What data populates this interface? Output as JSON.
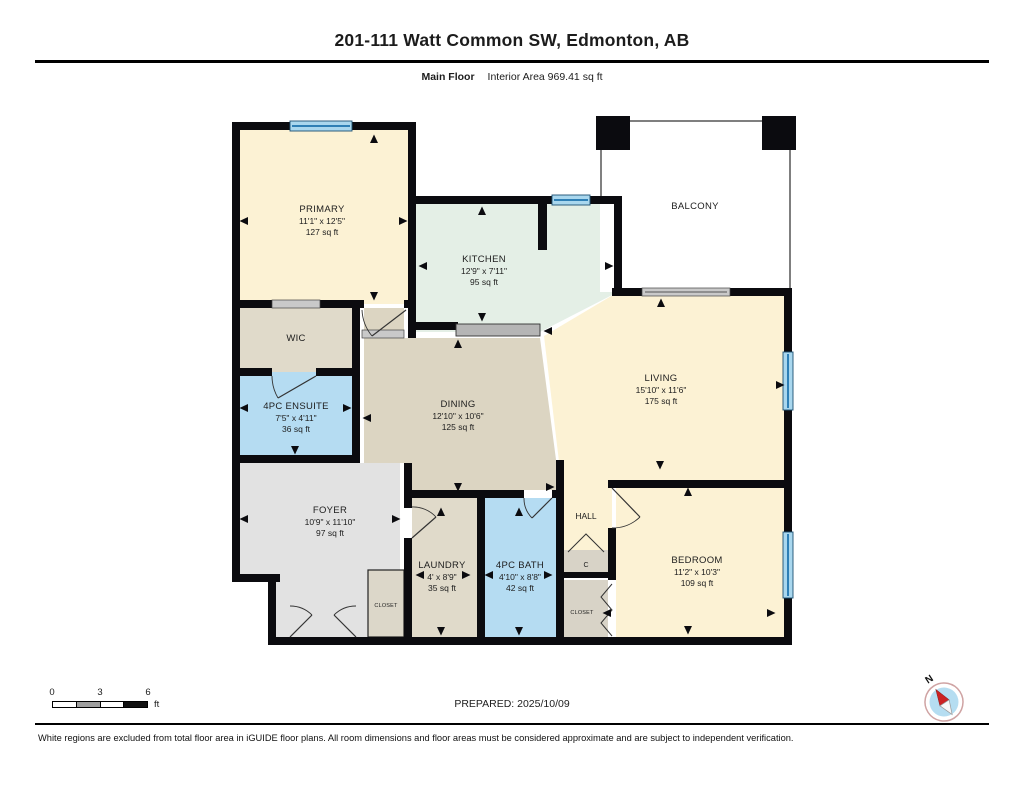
{
  "header": {
    "title": "201-111 Watt Common SW, Edmonton, AB",
    "floor_label": "Main Floor",
    "area_label": "Interior Area 969.41 sq ft"
  },
  "rooms": {
    "primary": {
      "name": "PRIMARY",
      "dims": "11'1\" x 12'5\"",
      "area": "127 sq ft"
    },
    "wic": {
      "name": "WIC"
    },
    "ensuite": {
      "name": "4PC ENSUITE",
      "dims": "7'5\" x 4'11\"",
      "area": "36 sq ft"
    },
    "kitchen": {
      "name": "KITCHEN",
      "dims": "12'9\" x 7'11\"",
      "area": "95 sq ft"
    },
    "balcony": {
      "name": "BALCONY"
    },
    "dining": {
      "name": "DINING",
      "dims": "12'10\" x 10'6\"",
      "area": "125 sq ft"
    },
    "living": {
      "name": "LIVING",
      "dims": "15'10\" x 11'6\"",
      "area": "175 sq ft"
    },
    "foyer": {
      "name": "FOYER",
      "dims": "10'9\" x 11'10\"",
      "area": "97 sq ft"
    },
    "laundry": {
      "name": "LAUNDRY",
      "dims": "4' x 8'9\"",
      "area": "35 sq ft"
    },
    "bath": {
      "name": "4PC BATH",
      "dims": "4'10\" x 8'8\"",
      "area": "42 sq ft"
    },
    "hall": {
      "name": "HALL"
    },
    "closet_c": {
      "name": "C"
    },
    "closet_foyer": {
      "name": "CLOSET"
    },
    "closet_bedroom": {
      "name": "CLOSET"
    },
    "bedroom": {
      "name": "BEDROOM",
      "dims": "11'2\" x 10'3\"",
      "area": "109 sq ft"
    }
  },
  "scale_bar": {
    "tick_0": "0",
    "tick_3": "3",
    "tick_6": "6",
    "unit": "ft"
  },
  "compass": {
    "north_label": "N"
  },
  "footer": {
    "prepared": "PREPARED: 2025/10/09",
    "disclaimer": "White regions are excluded from total floor area in iGUIDE floor plans. All room dimensions and floor areas must be considered approximate and are subject to independent verification."
  },
  "colors": {
    "room_cream": "#fcf2d4",
    "room_mint": "#e4efe6",
    "room_tan_dining": "#dcd5c2",
    "room_tan": "#e0daca",
    "room_blue": "#b5dcf2",
    "room_gray": "#e2e2e2",
    "closet_gray": "#d8d3c7",
    "wall": "#0b0b0f",
    "window_fill": "#a9d7ee",
    "window_line": "#2e7fb5",
    "door_gray": "#c9c9c9"
  }
}
